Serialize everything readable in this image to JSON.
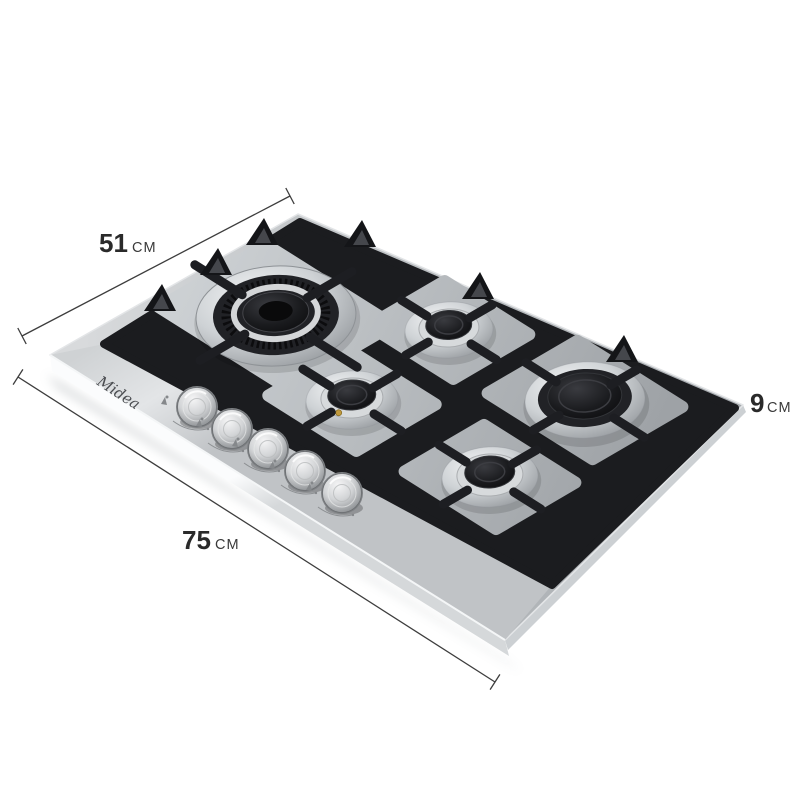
{
  "scene": {
    "background_color": "#ffffff",
    "view": "isometric product render"
  },
  "product": {
    "brand": "Midea",
    "burner_count": 5,
    "knob_count": 5,
    "finish_color": "#c3c7ca",
    "grate_color": "#1b1c1f",
    "brass_injector_color": "#c19a3d"
  },
  "dimensions": {
    "depth": {
      "value": "51",
      "unit": "CM"
    },
    "width": {
      "value": "75",
      "unit": "CM"
    },
    "height": {
      "value": "9",
      "unit": "CM"
    }
  },
  "annotation": {
    "line_color": "#3d3d3d",
    "number_color": "#2a2a2a",
    "unit_color": "#3a3a3a"
  }
}
